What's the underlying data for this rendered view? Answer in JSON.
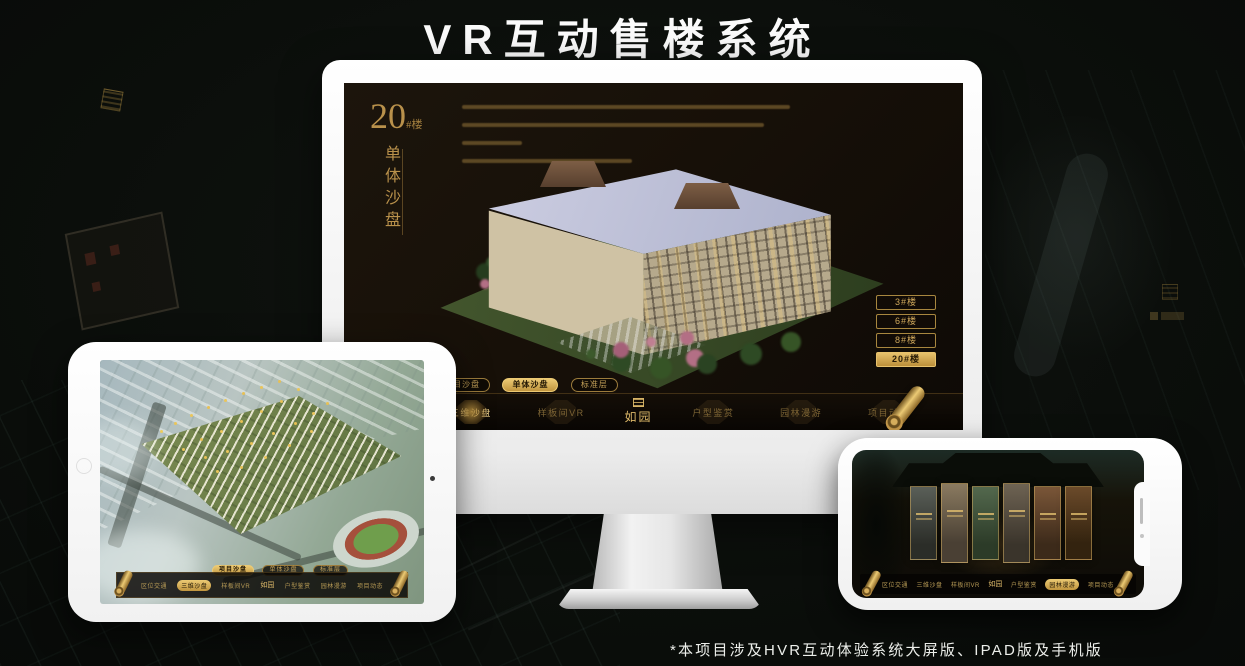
{
  "header": {
    "title": "VR互动售楼系统"
  },
  "footer": {
    "note": "*本项目涉及HVR互动体验系统大屏版、IPAD版及手机版"
  },
  "colors": {
    "gold": "#c79a4b",
    "gold_bright": "#ecca74",
    "screen_bg": "#171008",
    "page_bg": "#0a0d0a"
  },
  "monitor": {
    "hero": {
      "number": "20",
      "suffix": "#楼",
      "subtitle": "单体沙盘"
    },
    "building_buttons": [
      {
        "label": "3#楼",
        "active": false
      },
      {
        "label": "6#楼",
        "active": false
      },
      {
        "label": "8#楼",
        "active": false
      },
      {
        "label": "20#楼",
        "active": true
      }
    ],
    "view_tabs": [
      {
        "label": "项目沙盘",
        "active": false
      },
      {
        "label": "单体沙盘",
        "active": true
      },
      {
        "label": "标准层",
        "active": false
      }
    ],
    "nav_left": [
      {
        "label": "区位交通",
        "active": false
      },
      {
        "label": "三维沙盘",
        "active": true
      },
      {
        "label": "样板间VR",
        "active": false
      }
    ],
    "logo": "如园",
    "nav_right": [
      {
        "label": "户型鉴赏",
        "active": false
      },
      {
        "label": "园林漫游",
        "active": false
      },
      {
        "label": "项目动态",
        "active": false
      }
    ]
  },
  "ipad": {
    "view_tabs": [
      {
        "label": "项目沙盘",
        "active": true
      },
      {
        "label": "单体沙盘",
        "active": false
      },
      {
        "label": "标准层",
        "active": false
      }
    ],
    "nav_left": [
      {
        "label": "区位交通",
        "active": false
      },
      {
        "label": "三维沙盘",
        "active": true
      },
      {
        "label": "样板间VR",
        "active": false
      }
    ],
    "logo": "如园",
    "nav_right": [
      {
        "label": "户型鉴赏",
        "active": false
      },
      {
        "label": "园林漫游",
        "active": false
      },
      {
        "label": "项目动态",
        "active": false
      }
    ]
  },
  "phone": {
    "nav_left": [
      {
        "label": "区位交通",
        "active": false
      },
      {
        "label": "三维沙盘",
        "active": false
      },
      {
        "label": "样板间VR",
        "active": false
      }
    ],
    "logo": "如园",
    "nav_right": [
      {
        "label": "户型鉴赏",
        "active": false
      },
      {
        "label": "园林漫游",
        "active": true
      },
      {
        "label": "项目动态",
        "active": false
      }
    ]
  }
}
